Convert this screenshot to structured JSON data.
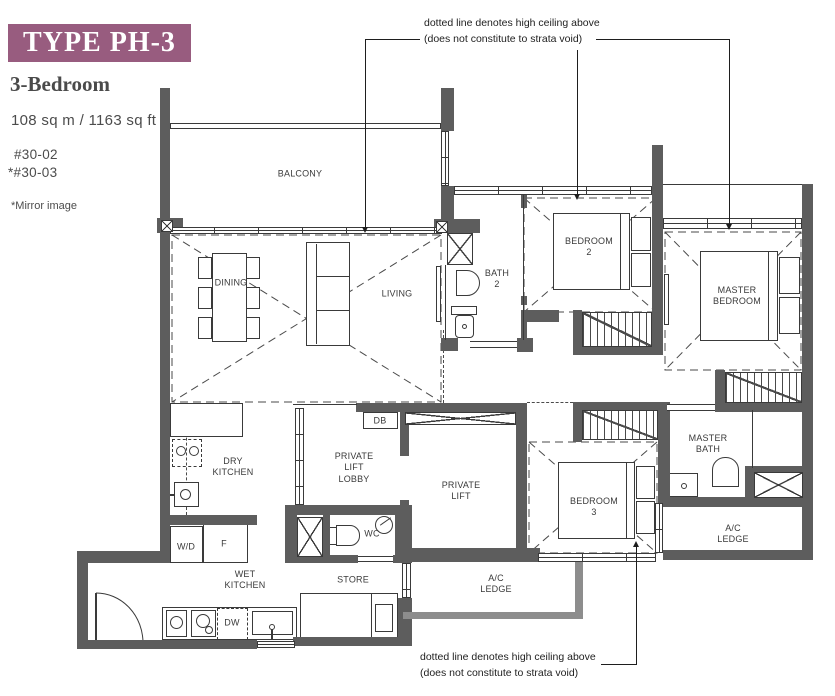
{
  "header": {
    "type_label": "TYPE PH-3",
    "bedroom_type": "3-Bedroom",
    "area": "108 sq m / 1163 sq ft",
    "unit1": "#30-02",
    "unit2": "*#30-03",
    "mirror_note": "*Mirror image"
  },
  "notes": {
    "high_ceiling_line1": "dotted line denotes high ceiling above",
    "high_ceiling_line2": "(does not constitute to strata void)"
  },
  "rooms": {
    "balcony": "BALCONY",
    "dining": "DINING",
    "living": "LIVING",
    "bath2": "BATH\n2",
    "bedroom2": "BEDROOM\n2",
    "master_bedroom": "MASTER\nBEDROOM",
    "dry_kitchen": "DRY\nKITCHEN",
    "private_lift_lobby": "PRIVATE\nLIFT\nLOBBY",
    "db": "DB",
    "private_lift": "PRIVATE\nLIFT",
    "wc": "WC",
    "washer_dryer": "W/D",
    "fridge": "F",
    "wet_kitchen": "WET\nKITCHEN",
    "store": "STORE",
    "dishwasher": "DW",
    "bedroom3": "BEDROOM\n3",
    "master_bath": "MASTER\nBATH",
    "ac_ledge_left": "A/C\nLEDGE",
    "ac_ledge_right": "A/C\nLEDGE"
  },
  "colors": {
    "title_bg": "#985C7F",
    "wall": "#5D5D5D"
  }
}
